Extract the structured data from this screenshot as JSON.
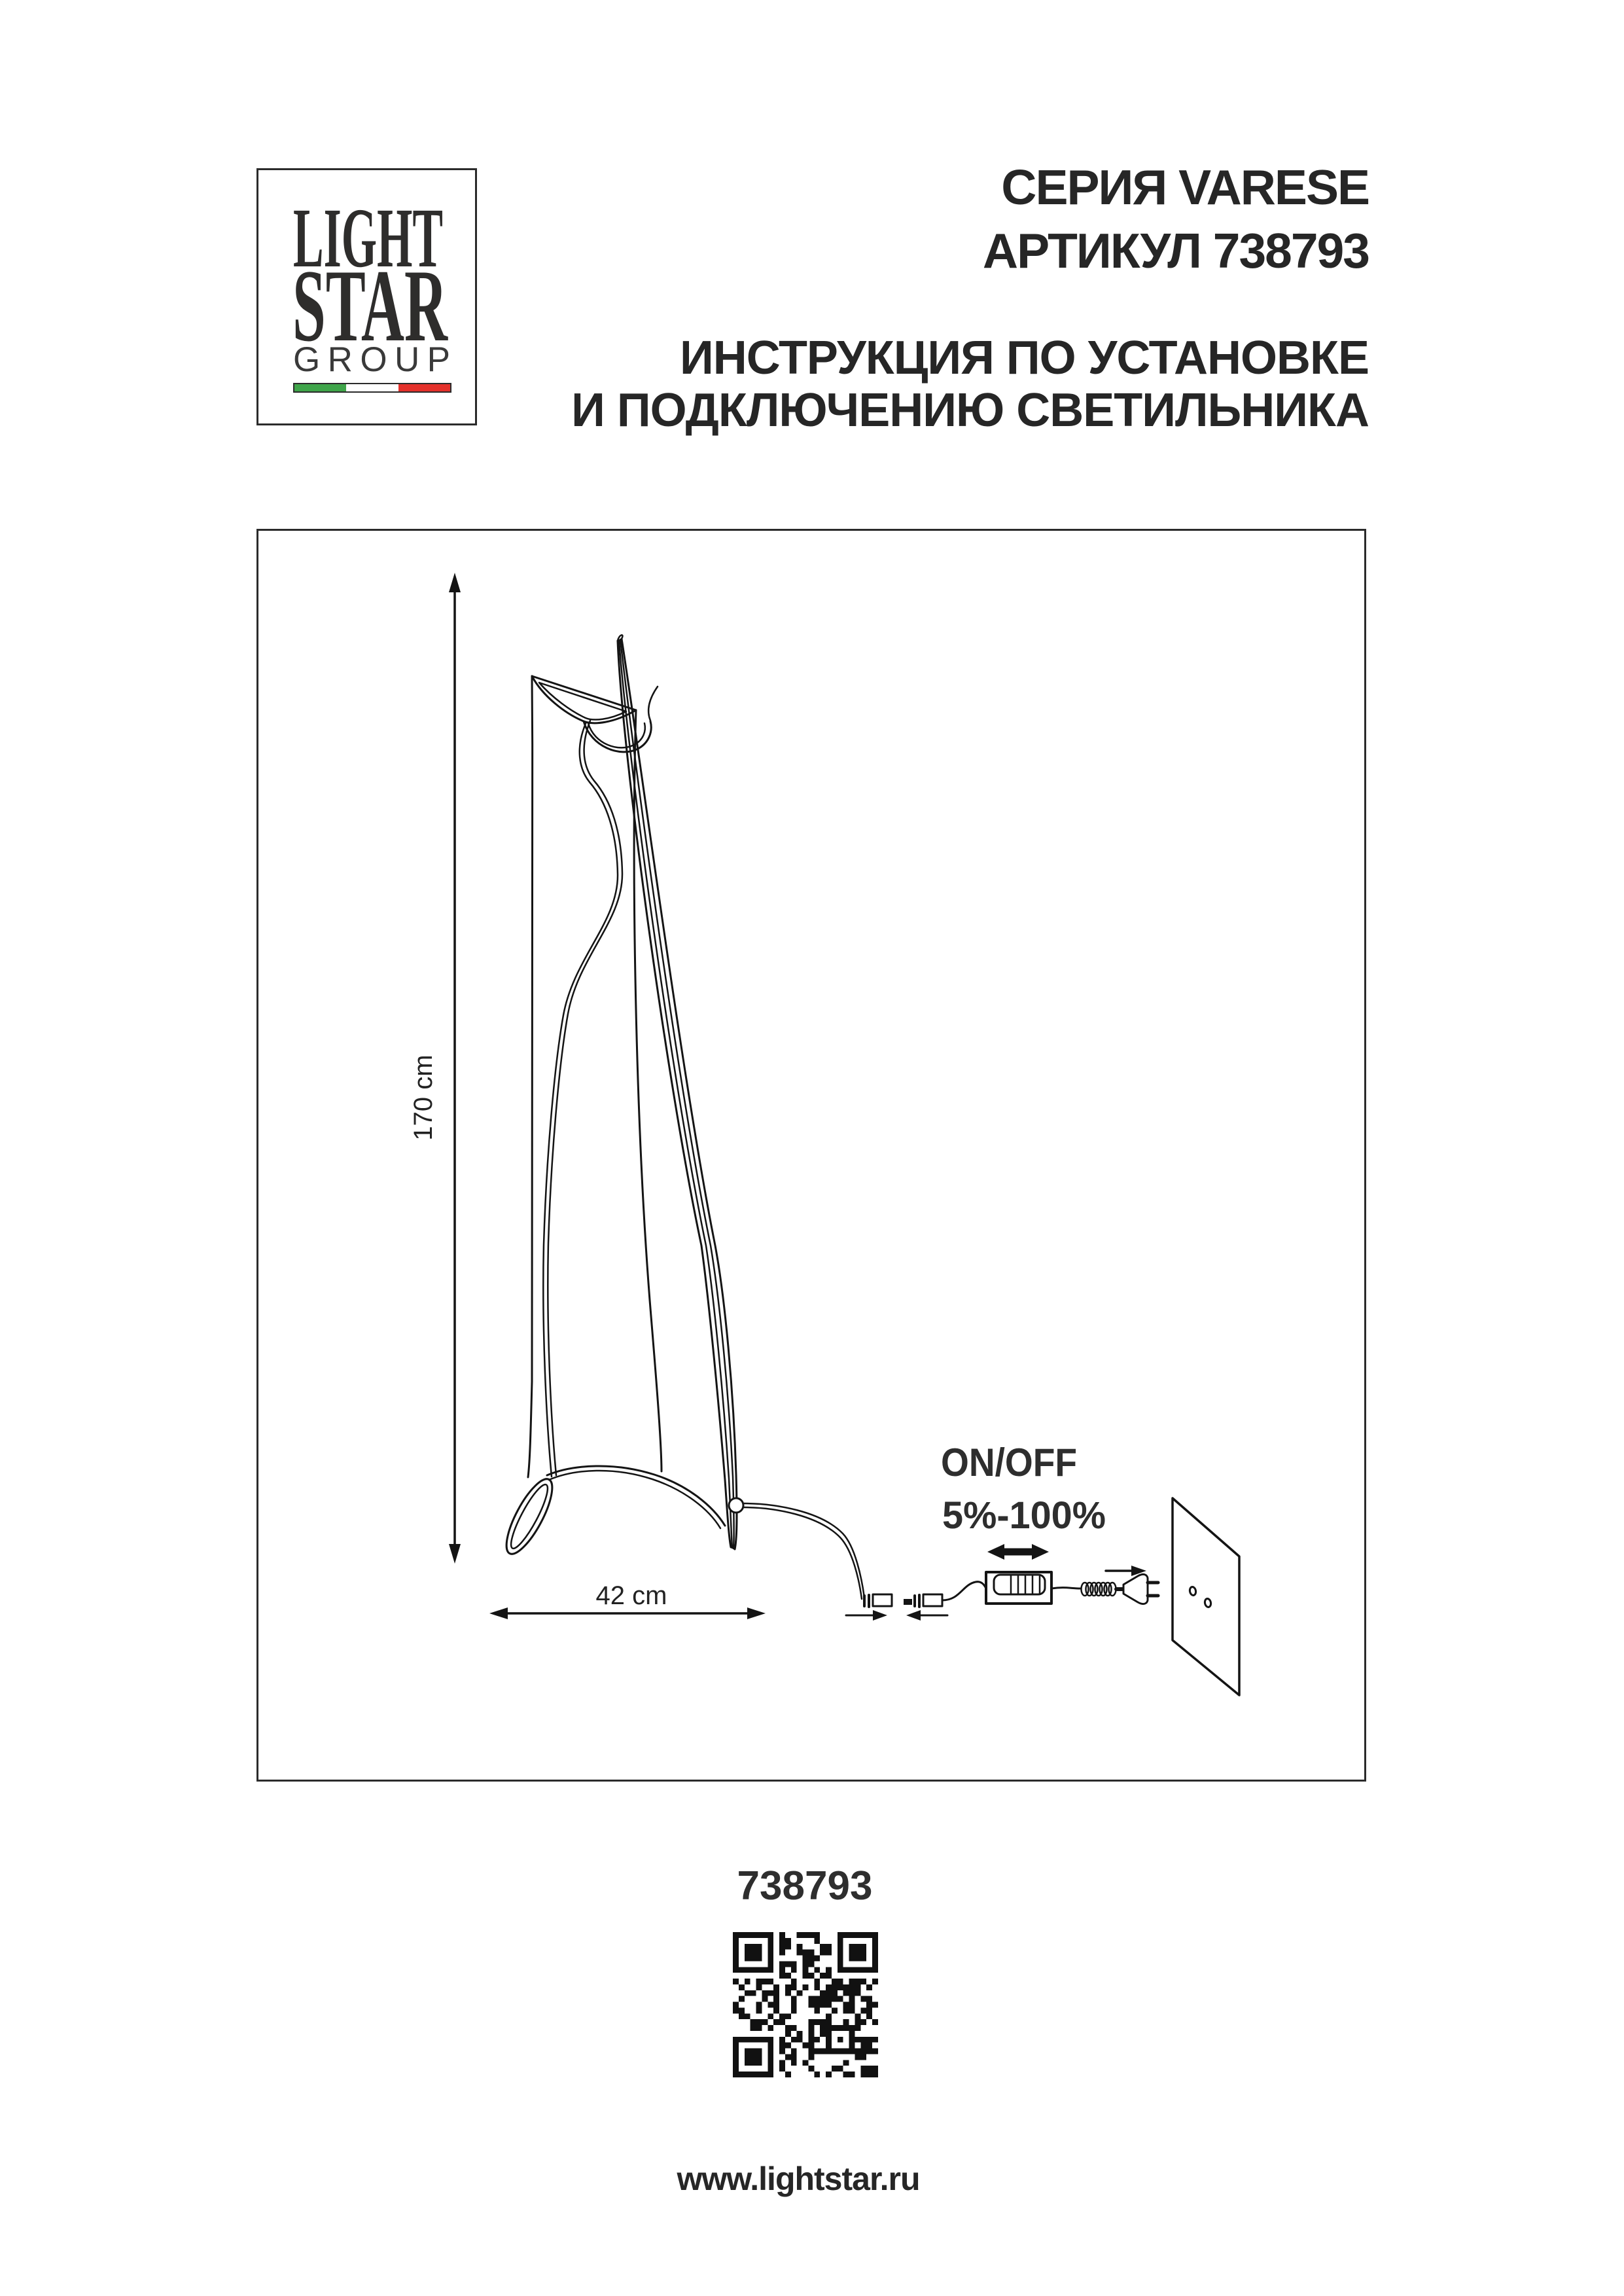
{
  "logo": {
    "word1": "LIGHT",
    "word2": "STAR",
    "word3": "GROUP",
    "flag": {
      "green": "#3fa54a",
      "white": "#ffffff",
      "red": "#e4312b"
    }
  },
  "header": {
    "series": "СЕРИЯ VARESE",
    "article_line": "АРТИКУЛ 738793",
    "instruction_line1": "ИНСТРУКЦИЯ ПО УСТАНОВКЕ",
    "instruction_line2": "И ПОДКЛЮЧЕНИЮ СВЕТИЛЬНИКА"
  },
  "diagram": {
    "height_label": "170 cm",
    "width_label": "42 cm",
    "switch_label_line1": "ON/OFF",
    "switch_label_line2": "5%-100%"
  },
  "footer": {
    "article_number": "738793",
    "website": "www.lightstar.ru"
  },
  "colors": {
    "ink": "#141414",
    "text": "#262626"
  }
}
